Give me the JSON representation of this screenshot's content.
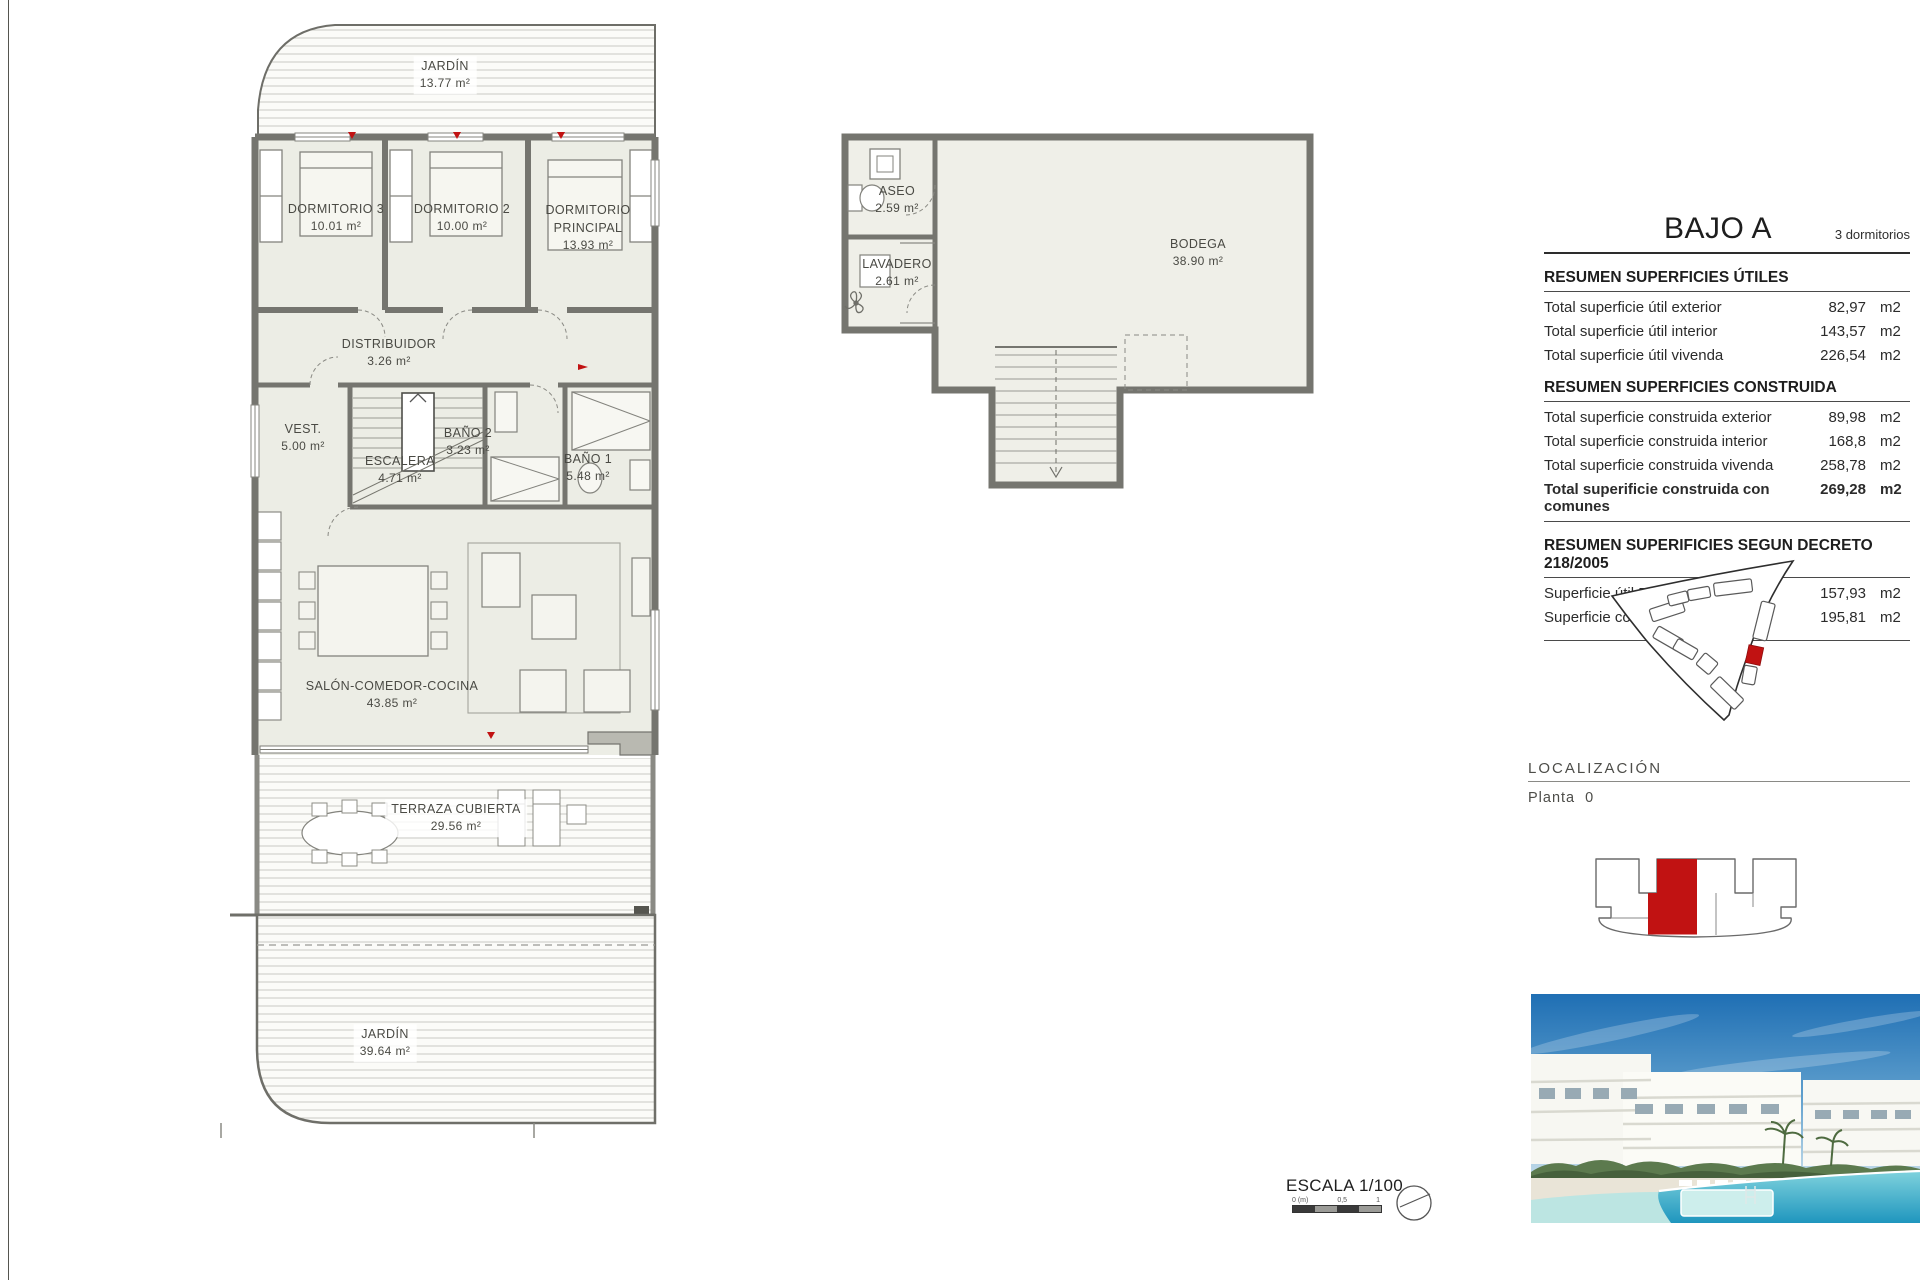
{
  "doc": {
    "title": "BAJO A",
    "subtitle": "3 dormitorios",
    "scale_label": "ESCALA 1/100",
    "scale_ticks": [
      "0 (m)",
      "0,5",
      "1"
    ],
    "localizacion": {
      "heading": "LOCALIZACIÓN",
      "planta": "Planta  0"
    }
  },
  "summary": {
    "utiles": {
      "heading": "RESUMEN SUPERFICIES ÚTILES",
      "rows": [
        {
          "label": "Total superficie útil exterior",
          "value": "82,97",
          "unit": "m2"
        },
        {
          "label": "Total superficie útil interior",
          "value": "143,57",
          "unit": "m2"
        },
        {
          "label": "Total superficie útil vivenda",
          "value": "226,54",
          "unit": "m2"
        }
      ]
    },
    "construida": {
      "heading": "RESUMEN SUPERFICIES CONSTRUIDA",
      "rows": [
        {
          "label": "Total superficie construida exterior",
          "value": "89,98",
          "unit": "m2"
        },
        {
          "label": "Total superficie construida interior",
          "value": "168,8",
          "unit": "m2"
        },
        {
          "label": "Total superficie construida vivenda",
          "value": "258,78",
          "unit": "m2"
        }
      ],
      "total": {
        "label": "Total superificie construida con comunes",
        "value": "269,28",
        "unit": "m2"
      }
    },
    "decreto": {
      "heading": "RESUMEN SUPERIFICIES SEGUN DECRETO 218/2005",
      "rows": [
        {
          "label": "Superficie útil BOJA",
          "value": "157,93",
          "unit": "m2"
        },
        {
          "label": "Superficie construida BOJA",
          "value": "195,81",
          "unit": "m2"
        }
      ]
    }
  },
  "floorplan": {
    "rooms": {
      "jardin_top": {
        "name": "JARDÍN",
        "area": "13.77 m²"
      },
      "dormitorio3": {
        "name": "DORMITORIO 3",
        "area": "10.01 m²"
      },
      "dormitorio2": {
        "name": "DORMITORIO 2",
        "area": "10.00 m²"
      },
      "dormitorio_principal": {
        "name": "DORMITORIO",
        "name2": "PRINCIPAL",
        "area": "13.93 m²"
      },
      "distribuidor": {
        "name": "DISTRIBUIDOR",
        "area": "3.26 m²"
      },
      "vestidor": {
        "name": "VEST.",
        "area": "5.00 m²"
      },
      "escalera": {
        "name": "ESCALERA",
        "area": "4.71 m²"
      },
      "bano2": {
        "name": "BAÑO 2",
        "area": "3.23 m²"
      },
      "bano1": {
        "name": "BAÑO 1",
        "area": "5.48 m²"
      },
      "salon": {
        "name": "SALÓN-COMEDOR-COCINA",
        "area": "43.85 m²"
      },
      "terraza": {
        "name": "TERRAZA CUBIERTA",
        "area": "29.56 m²"
      },
      "jardin_bottom": {
        "name": "JARDÍN",
        "area": "39.64 m²"
      }
    }
  },
  "bodega_plan": {
    "rooms": {
      "aseo": {
        "name": "ASEO",
        "area": "2.59 m²"
      },
      "lavadero": {
        "name": "LAVADERO",
        "area": "2.61 m²"
      },
      "bodega": {
        "name": "BODEGA",
        "area": "38.90 m²"
      }
    }
  },
  "colors": {
    "accent_red": "#c11212",
    "room_fill": "#ecede5",
    "wall_gray": "#75756f"
  }
}
